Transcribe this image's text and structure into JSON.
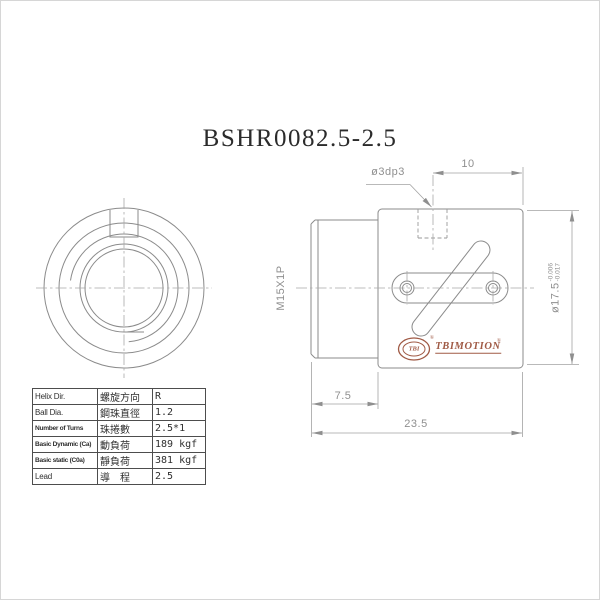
{
  "title": "BSHR0082.5-2.5",
  "dimensions": {
    "hole_callout": "ø3dp3",
    "hole_offset": "10",
    "thread_spec": "M15X1P",
    "outer_diameter": "ø17.5",
    "od_tolerance_upper": "-0.006",
    "od_tolerance_lower": "-0.017",
    "thread_length": "7.5",
    "overall_length": "23.5"
  },
  "logo": {
    "mark_text": "TBI",
    "brand": "TBIMOTION",
    "registered": "®"
  },
  "spec_table": {
    "rows": [
      {
        "en": "Helix Dir.",
        "zh": "螺旋方向",
        "value": "R"
      },
      {
        "en": "Ball Dia.",
        "zh": "鋼珠直徑",
        "value": "1.2"
      },
      {
        "en": "Number of Turns",
        "zh": "珠捲數",
        "value": "2.5*1"
      },
      {
        "en": "Basic Dynamic (Ca)",
        "zh": "動負荷",
        "value": "189 kgf"
      },
      {
        "en": "Basic static (C0a)",
        "zh": "靜負荷",
        "value": "381 kgf"
      },
      {
        "en": "Lead",
        "zh": "導　程",
        "value": "2.5"
      }
    ]
  },
  "colors": {
    "outline": "#8b8b8b",
    "dim_line": "#a2a2a2",
    "centerline": "#a8a8a8",
    "table_text": "#2f2f2f",
    "logo": "#a05a45",
    "title_text": "#2b2b2b"
  }
}
